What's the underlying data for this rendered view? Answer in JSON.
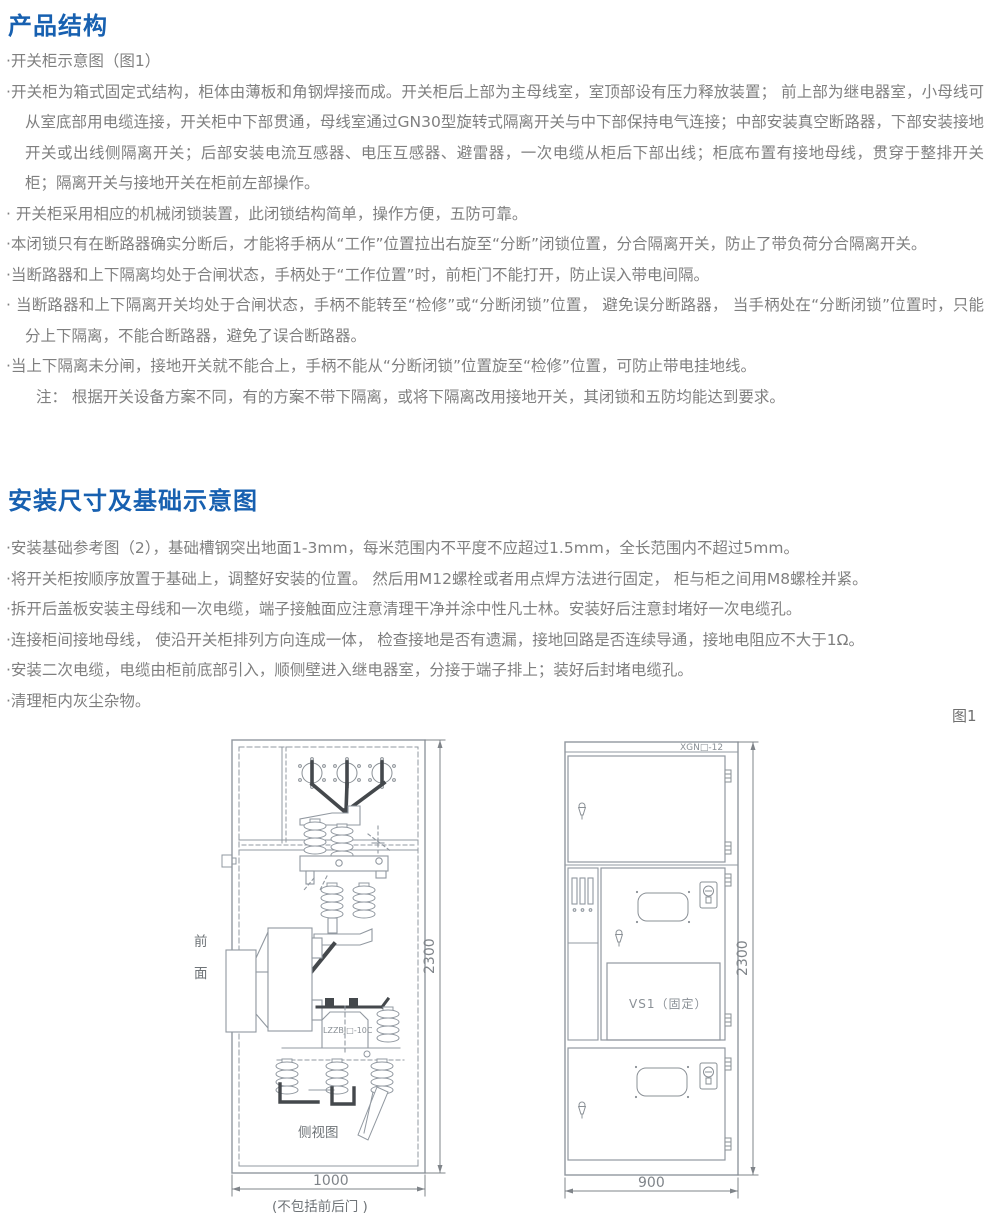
{
  "colors": {
    "heading_blue": "#1760b0",
    "body_gray": "#7f7f7f",
    "diagram_line": "#9198a0",
    "diagram_dark": "#44484c"
  },
  "product": {
    "heading": "产品结构",
    "bullets": [
      "·开关柜示意图（图1）",
      "·开关柜为箱式固定式结构，柜体由薄板和角钢焊接而成。开关柜后上部为主母线室，室顶部设有压力释放装置； 前上部为继电器室，小母线可从室底部用电缆连接，开关柜中下部贯通，母线室通过GN30型旋转式隔离开关与中下部保持电气连接；中部安装真空断路器，下部安装接地开关或出线侧隔离开关；后部安装电流互感器、电压互感器、避雷器，一次电缆从柜后下部出线；柜底布置有接地母线，贯穿于整排开关柜；隔离开关与接地开关在柜前左部操作。",
      "· 开关柜采用相应的机械闭锁装置，此闭锁结构简单，操作方便，五防可靠。",
      "·本闭锁只有在断路器确实分断后，才能将手柄从“工作”位置拉出右旋至“分断”闭锁位置，分合隔离开关，防止了带负荷分合隔离开关。",
      "·当断路器和上下隔离均处于合闸状态，手柄处于“工作位置”时，前柜门不能打开，防止误入带电间隔。",
      "· 当断路器和上下隔离开关均处于合闸状态，手柄不能转至“检修”或“分断闭锁”位置， 避免误分断路器， 当手柄处在“分断闭锁”位置时，只能分上下隔离，不能合断路器，避免了误合断路器。",
      "·当上下隔离未分闸，接地开关就不能合上，手柄不能从“分断闭锁”位置旋至“检修”位置，可防止带电挂地线。",
      "注： 根据开关设备方案不同，有的方案不带下隔离，或将下隔离改用接地开关，其闭锁和五防均能达到要求。"
    ]
  },
  "install": {
    "heading": "安装尺寸及基础示意图",
    "bullets": [
      "·安装基础参考图（2），基础槽钢突出地面1-3mm，每米范围内不平度不应超过1.5mm，全长范围内不超过5mm。",
      "·将开关柜按顺序放置于基础上，调整好安装的位置。 然后用M12螺栓或者用点焊方法进行固定， 柜与柜之间用M8螺栓并紧。",
      "·拆开后盖板安装主母线和一次电缆，端子接触面应注意清理干净并涂中性凡士林。安装好后注意封堵好一次电缆孔。",
      "·连接柜间接地母线， 使沿开关柜排列方向连成一体， 检查接地是否有遗漏，接地回路是否连续导通，接地电阻应不大于1Ω。",
      "·安装二次电缆，电缆由柜前底部引入，顺侧壁进入继电器室，分接于端子排上；装好后封堵电缆孔。",
      "·清理柜内灰尘杂物。"
    ]
  },
  "figure": {
    "caption": "图1",
    "side_view": {
      "front_char_1": "前",
      "front_char_2": "面",
      "name": "侧视图",
      "ct_label": "LZZBJ□-10C",
      "width_dim": "1000",
      "width_note": "(不包括前后门 )",
      "height_dim": "2300"
    },
    "front_view": {
      "model_label": "XGN□-12",
      "breaker_label": "VS1（固定）",
      "width_dim": "900",
      "height_dim": "2300"
    }
  }
}
